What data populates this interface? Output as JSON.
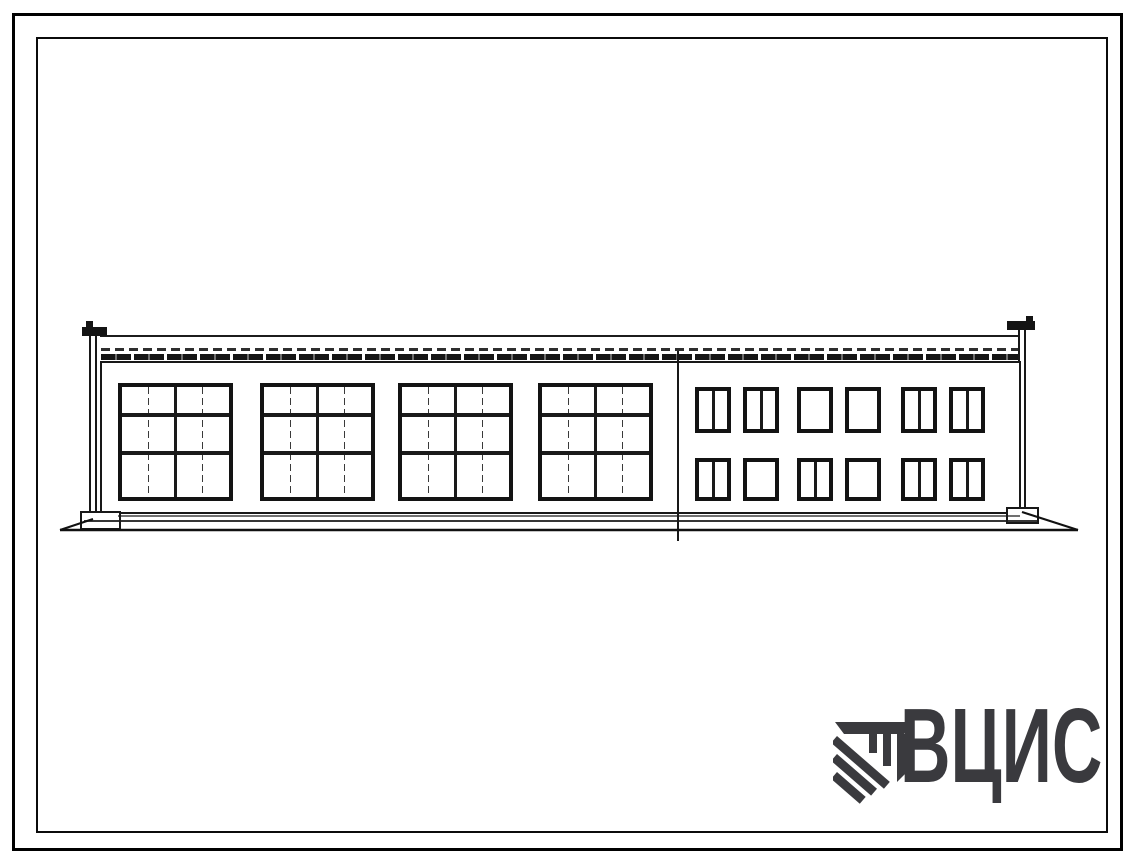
{
  "page": {
    "background": "#ffffff",
    "frame_color": "#000000",
    "ink_color": "#1a1a1a"
  },
  "elevation": {
    "kind": "building-facade-elevation",
    "left_section": {
      "large_window_count": 4,
      "center_mullion": true,
      "transom_positions_pct": [
        24,
        58
      ],
      "thin_mullion_positions_pct": [
        24,
        75
      ]
    },
    "right_section": {
      "rows": 2,
      "columns": 6,
      "window_mullions": [
        [
          true,
          true,
          false,
          false,
          true,
          true
        ],
        [
          true,
          false,
          true,
          false,
          true,
          true
        ]
      ]
    },
    "expansion_joint": true,
    "parapet_caps": 2,
    "downpipes": 2
  },
  "logo": {
    "text": "ВЦИС",
    "color": "#3a3a3e",
    "mark": "hatched-column-emblem"
  }
}
